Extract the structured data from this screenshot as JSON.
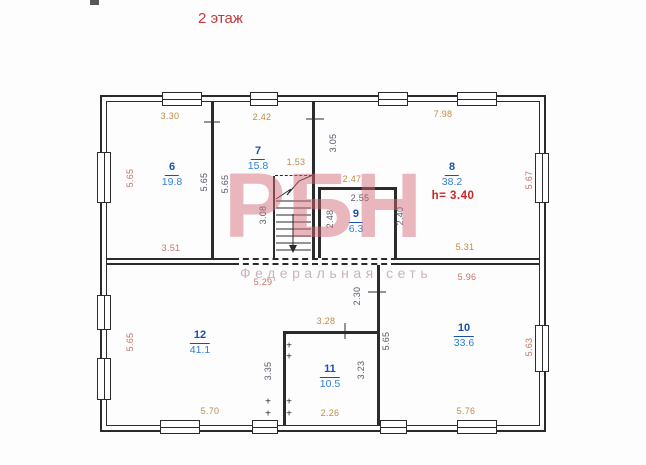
{
  "title": "2 этаж",
  "watermark": {
    "logo": "РБН",
    "tagline": "Федеральная сеть"
  },
  "colors": {
    "title_red": "#c3393b",
    "room_label_blue": "#1a4fae",
    "room_area_blue": "#2f7fd4",
    "note_red": "#cc2525",
    "dim_orange": "#bf8a45",
    "dim_redbrown": "#c4756d",
    "dim_dark": "#565b66",
    "watermark_pink": "#d26976",
    "line": "#2b2b2b"
  },
  "plan": {
    "rooms": [
      {
        "number": "6",
        "area": "19.8"
      },
      {
        "number": "7",
        "area": "15.8"
      },
      {
        "number": "8",
        "area": "38.2",
        "height_note": "h= 3.40"
      },
      {
        "number": "9",
        "area": "6.3"
      },
      {
        "number": "10",
        "area": "33.6"
      },
      {
        "number": "11",
        "area": "10.5"
      },
      {
        "number": "12",
        "area": "41.1"
      }
    ],
    "dimensions": [
      {
        "id": "room6-top",
        "value": "3.30"
      },
      {
        "id": "room7-top",
        "value": "2.42"
      },
      {
        "id": "room8-top",
        "value": "7.98"
      },
      {
        "id": "exterior-left-upper",
        "value": "5.65"
      },
      {
        "id": "room6-right",
        "value": "5.65"
      },
      {
        "id": "room7-left",
        "value": "5.65"
      },
      {
        "id": "wall-7-8",
        "value": "3.05"
      },
      {
        "id": "exterior-right-upper",
        "value": "5.67"
      },
      {
        "id": "stairs-width",
        "value": "1.53"
      },
      {
        "id": "stairs-height",
        "value": "3.08"
      },
      {
        "id": "room9-outside-top",
        "value": "2.47"
      },
      {
        "id": "room9-top",
        "value": "2.55"
      },
      {
        "id": "room9-left",
        "value": "2.48"
      },
      {
        "id": "room9-right",
        "value": "2.40"
      },
      {
        "id": "room6-bottom",
        "value": "3.51"
      },
      {
        "id": "room8-bottom",
        "value": "5.31"
      },
      {
        "id": "room12-top",
        "value": "5.29"
      },
      {
        "id": "room10-top",
        "value": "5.96"
      },
      {
        "id": "wall-segment",
        "value": "2.30"
      },
      {
        "id": "room11-top",
        "value": "3.28"
      },
      {
        "id": "room10-left",
        "value": "5.65"
      },
      {
        "id": "exterior-left-lower",
        "value": "5.65"
      },
      {
        "id": "room12-right",
        "value": "3.35"
      },
      {
        "id": "room11-right",
        "value": "3.23"
      },
      {
        "id": "exterior-right-lower",
        "value": "5.63"
      },
      {
        "id": "room12-bottom",
        "value": "5.70"
      },
      {
        "id": "room11-bottom",
        "value": "2.26"
      },
      {
        "id": "room10-bottom",
        "value": "5.76"
      }
    ],
    "symbols": {
      "wall_material_mark": "+"
    }
  }
}
